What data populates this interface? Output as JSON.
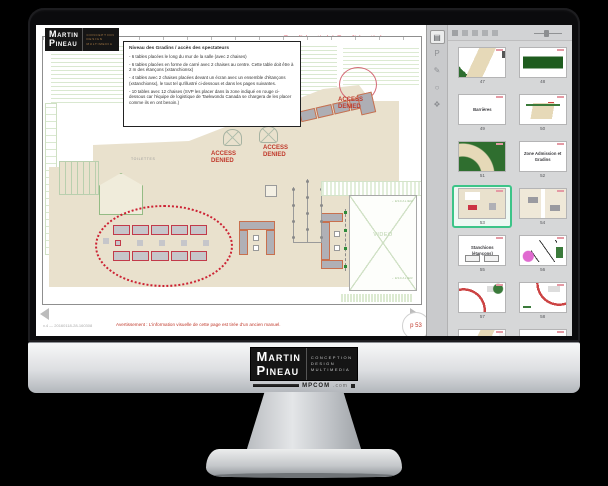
{
  "monitor": {
    "brand": {
      "name_top": "Martin",
      "name_bottom": "Pineau",
      "tagline": [
        "CONCEPTION",
        "DESIGN",
        "MULTIMEDIA"
      ],
      "domain": "MPCOM",
      "domain_suffix": ".com"
    }
  },
  "document": {
    "logo": {
      "name_top": "Martin",
      "name_bottom": "Pineau",
      "tagline": [
        "CONCEPTION",
        "DESIGN",
        "MULTIMEDIA"
      ]
    },
    "confidential": "Confidentiel / Confidential",
    "note": {
      "title": "Niveau des Gradins / accès des spectateurs",
      "bullets": [
        "6 tables placées le long du mur de la salle (avec 2 chaises)",
        "6 tables placées en forme de carré avec 2 chaises au centre. Cette table doit être à 2 m des étançons (xstanchionsx)",
        "4 tables avec 2 chaises placées devant un écran avec un ensemble d'étançons (xstanchionsx), le tout tel qu'illustré ci-dessous et dans les pages suivantes.",
        "10 tables avec 12 chaises (SVP les placer dans la zone indiqué en rouge ci-dessous car l'équipe de logistique de Taekwondo Canada se chargera de les placer comme ils en ont besoin.)"
      ]
    },
    "plan": {
      "access_denied": "ACCESS DENIED",
      "toilettes": "TOILETTES",
      "video": "VIDEO",
      "escalier": "ESCALIER"
    },
    "footer": {
      "version": "v.4 — 20160118-28-160308",
      "warning": "Avertissement : L'information visuelle de cette page est tirée d'un ancien manuel.",
      "page": "p 53"
    }
  },
  "sidebar": {
    "selected_color": "#3cc488",
    "rail_icons": [
      {
        "name": "pages-panel",
        "glyph": "▤"
      },
      {
        "name": "bookmarks-panel",
        "glyph": "P"
      },
      {
        "name": "annotations-panel",
        "glyph": "✎"
      },
      {
        "name": "comments-panel",
        "glyph": "○"
      },
      {
        "name": "signatures-panel",
        "glyph": "❖"
      }
    ],
    "thumbnails": [
      {
        "number": "47",
        "label": ""
      },
      {
        "number": "48",
        "label": ""
      },
      {
        "number": "49",
        "label": "Barrières"
      },
      {
        "number": "50",
        "label": ""
      },
      {
        "number": "51",
        "label": ""
      },
      {
        "number": "52",
        "label": "Zone Admission et Gradins"
      },
      {
        "number": "53",
        "label": ""
      },
      {
        "number": "54",
        "label": ""
      },
      {
        "number": "55",
        "label": "Stanchions (étançons)"
      },
      {
        "number": "56",
        "label": ""
      },
      {
        "number": "57",
        "label": ""
      },
      {
        "number": "58",
        "label": ""
      },
      {
        "number": "59",
        "label": ""
      },
      {
        "number": "60",
        "label": "Rideaux"
      },
      {
        "number": "61",
        "label": ""
      },
      {
        "number": "62",
        "label": ""
      }
    ]
  },
  "colors": {
    "confidential_pink": "#ef8a96",
    "warning_red": "#c0392b",
    "floor_beige": "#e9e1cd",
    "plan_green": "#d9e8d0",
    "table_border_orange": "#c8704e",
    "zone_red": "#cc2233",
    "selected_green": "#3cc488"
  }
}
